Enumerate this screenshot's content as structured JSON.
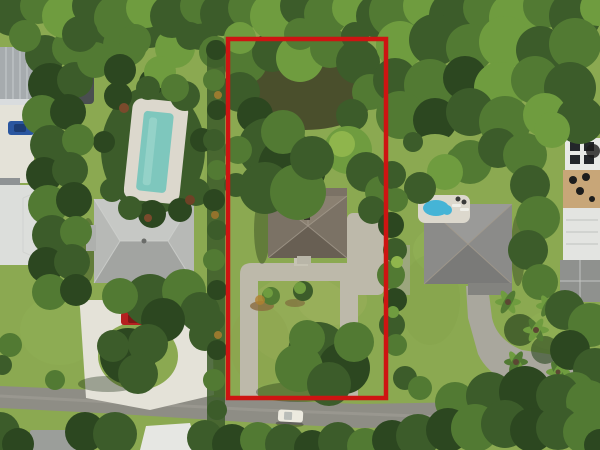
{
  "meta": {
    "type": "aerial-drone-photo",
    "description": "Overhead aerial view of a residential lot outlined with a red property-boundary rectangle; subject home with U-shaped gravel drive, neighbors with pools, circular driveway, dense tree canopy and a road across the bottom with a white car."
  },
  "annotation": {
    "kind": "property-boundary",
    "shape": "rectangle",
    "color": "#ce1412"
  },
  "colors": {
    "boundary": "#ce1412",
    "grass": "#8ba951",
    "grass_light": "#a8b466",
    "grass_dark": "#74923f",
    "ground_shade": "#4a4f2c",
    "road": "#8e8d85",
    "road_stripe": "#a3a299",
    "gravel_drive": "#bdb9aa",
    "concrete_drive": "#e4e2d8",
    "neighbor_drive": "#a9a79d",
    "subject_roof": "#7b7265",
    "subject_roof_light": "#8a8071",
    "subject_roof_dark": "#685f53",
    "left_roof": "#b7b9b6",
    "left_roof_light": "#c6c8c5",
    "left_roof_dark": "#a2a4a1",
    "right_roof": "#8b8b89",
    "right_roof_light": "#9a9a98",
    "right_roof_dark": "#7a7a78",
    "white_roof": "#dcdedb",
    "metal_roof": "#a6abae",
    "pool_teal": "#7ec7bd",
    "pool_blue": "#45b4d6",
    "pool_deck": "#dcd8cd",
    "deck_tan": "#c8a678",
    "car_red": "#b52020",
    "car_blue": "#2a56a0",
    "car_white": "#eceadf",
    "trailer": "#4a4e50",
    "shadow": "rgba(24,40,16,0.35)"
  },
  "objects": {
    "subject_house": "single-story hip-roof house",
    "left_pool": "rectangular teal pool with white deck",
    "right_pool": "small blue kidney pool with deck",
    "vehicles": [
      "red car on left driveway",
      "blue car top-left",
      "white car on road"
    ]
  }
}
